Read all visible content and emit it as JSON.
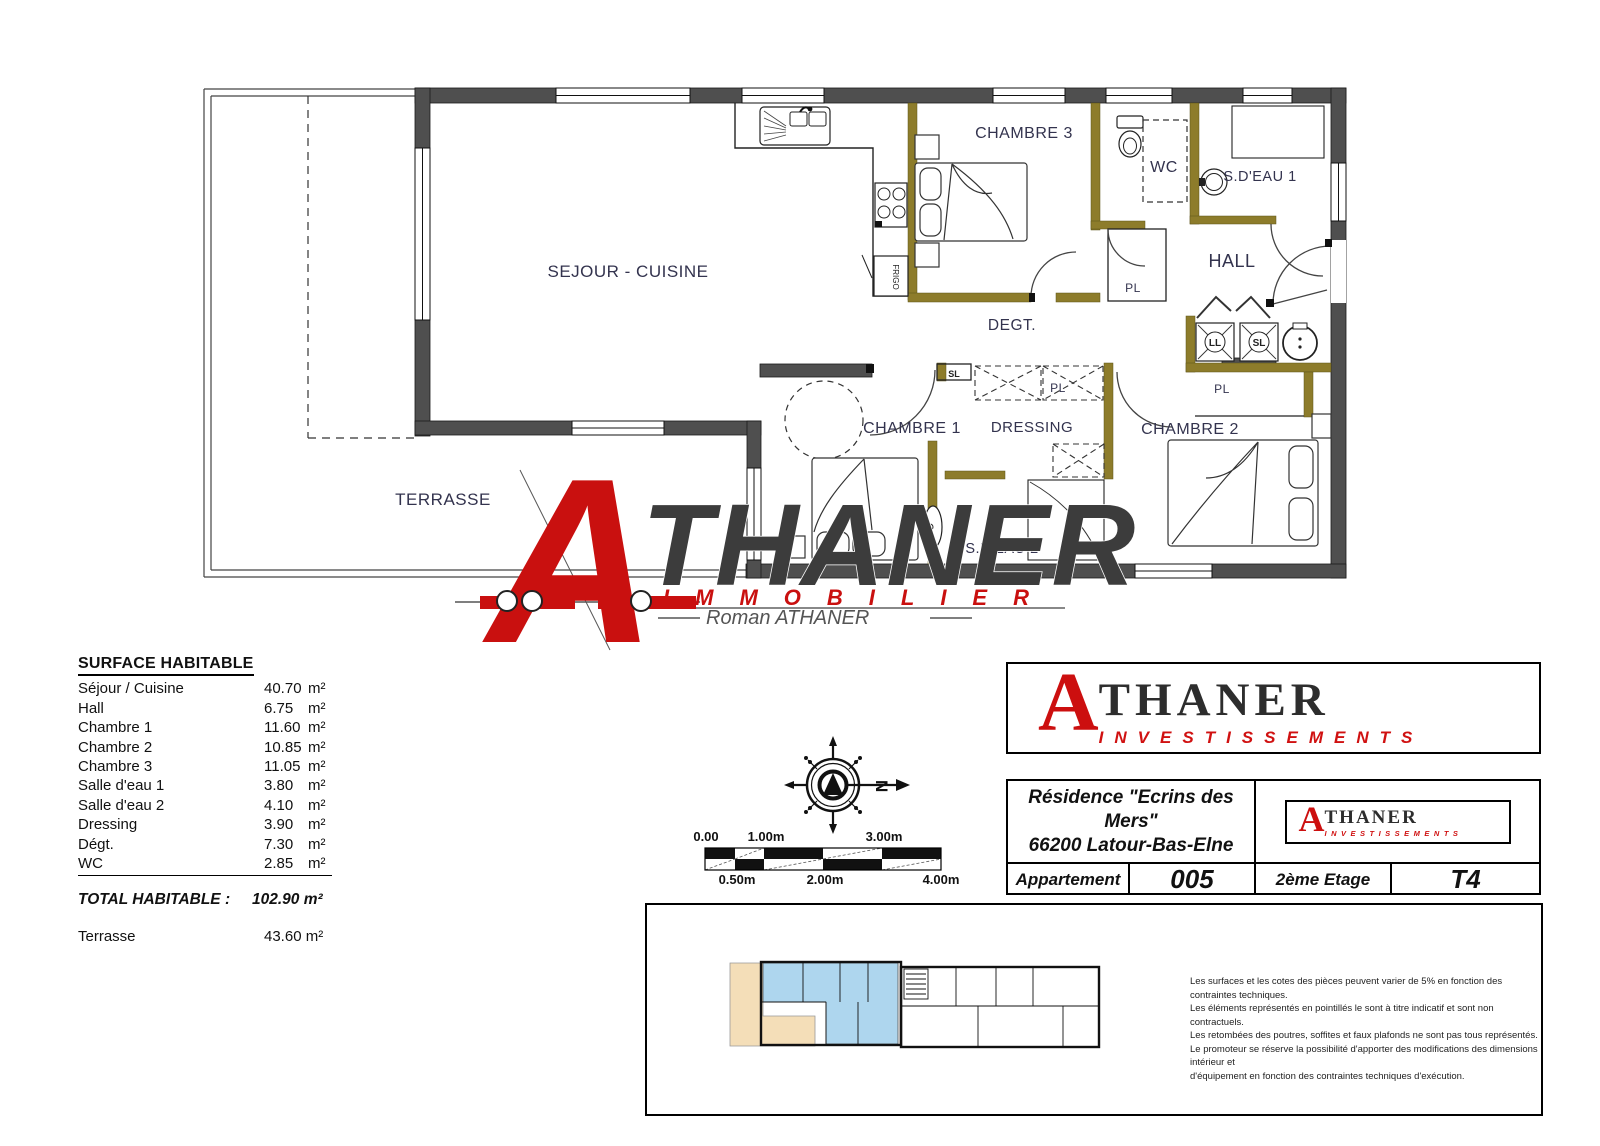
{
  "plan": {
    "room_labels": {
      "sejour": "SEJOUR - CUISINE",
      "chambre3": "CHAMBRE 3",
      "wc": "WC",
      "sdeau1": "S.D'EAU 1",
      "hall": "HALL",
      "degt": "DEGT.",
      "chambre1": "CHAMBRE 1",
      "dressing": "DRESSING",
      "chambre2": "CHAMBRE 2",
      "sdeau2": "S.D'EAU 2",
      "terrasse": "TERRASSE"
    },
    "fixtures": {
      "frigo": "FRIGO",
      "pl": "PL",
      "sl": "SL",
      "ll": "LL"
    }
  },
  "watermark": {
    "initial": "A",
    "name": "THANER",
    "immobilier": "IMMOBILIER",
    "signature": "Roman ATHANER"
  },
  "surface_table": {
    "title": "SURFACE HABITABLE",
    "rows": [
      {
        "label": "Séjour / Cuisine",
        "value": "40.70",
        "unit": "m²"
      },
      {
        "label": "Hall",
        "value": "6.75",
        "unit": "m²"
      },
      {
        "label": "Chambre 1",
        "value": "11.60",
        "unit": "m²"
      },
      {
        "label": "Chambre 2",
        "value": "10.85",
        "unit": "m²"
      },
      {
        "label": "Chambre 3",
        "value": "11.05",
        "unit": "m²"
      },
      {
        "label": "Salle d'eau 1",
        "value": "3.80",
        "unit": "m²"
      },
      {
        "label": "Salle d'eau 2",
        "value": "4.10",
        "unit": "m²"
      },
      {
        "label": "Dressing",
        "value": "3.90",
        "unit": "m²"
      },
      {
        "label": "Dégt.",
        "value": "7.30",
        "unit": "m²"
      },
      {
        "label": "WC",
        "value": "2.85",
        "unit": "m²"
      }
    ],
    "total_label": "TOTAL HABITABLE :",
    "total_value": "102.90 m²",
    "terrace_label": "Terrasse",
    "terrace_value": "43.60 m²"
  },
  "compass": {
    "north_letter": "N"
  },
  "scale_bar": {
    "top_labels": [
      "0.00",
      "1.00m",
      "3.00m"
    ],
    "bottom_labels": [
      "0.50m",
      "2.00m",
      "4.00m"
    ]
  },
  "title_block": {
    "logo": {
      "initial": "A",
      "name": "THANER",
      "subtitle": "INVESTISSEMENTS"
    },
    "residence_name": "Résidence \"Ecrins des Mers\"",
    "residence_city": "66200 Latour-Bas-Elne",
    "apartment_label": "Appartement",
    "apartment_number": "005",
    "floor": "2ème Etage",
    "type": "T4"
  },
  "disclaimer": {
    "lines": [
      "Les surfaces et les cotes des pièces peuvent varier de 5% en fonction des contraintes techniques.",
      "Les éléments représentés en pointillés le sont à titre indicatif et sont non contractuels.",
      "Les retombées des poutres, soffites et faux plafonds ne sont pas tous représentés.",
      "Le promoteur se réserve la possibilité d'apporter des modifications des dimensions intérieur et",
      "d'équipement en fonction des contraintes techniques d'exécution."
    ]
  },
  "colors": {
    "wall": "#4f4f4f",
    "partition": "#8d7c2b",
    "brand_red": "#c9100f",
    "label_ink": "#33334e",
    "minimap_unit_blue": "#aed6ee",
    "minimap_terrace_tan": "#f4deb8"
  }
}
